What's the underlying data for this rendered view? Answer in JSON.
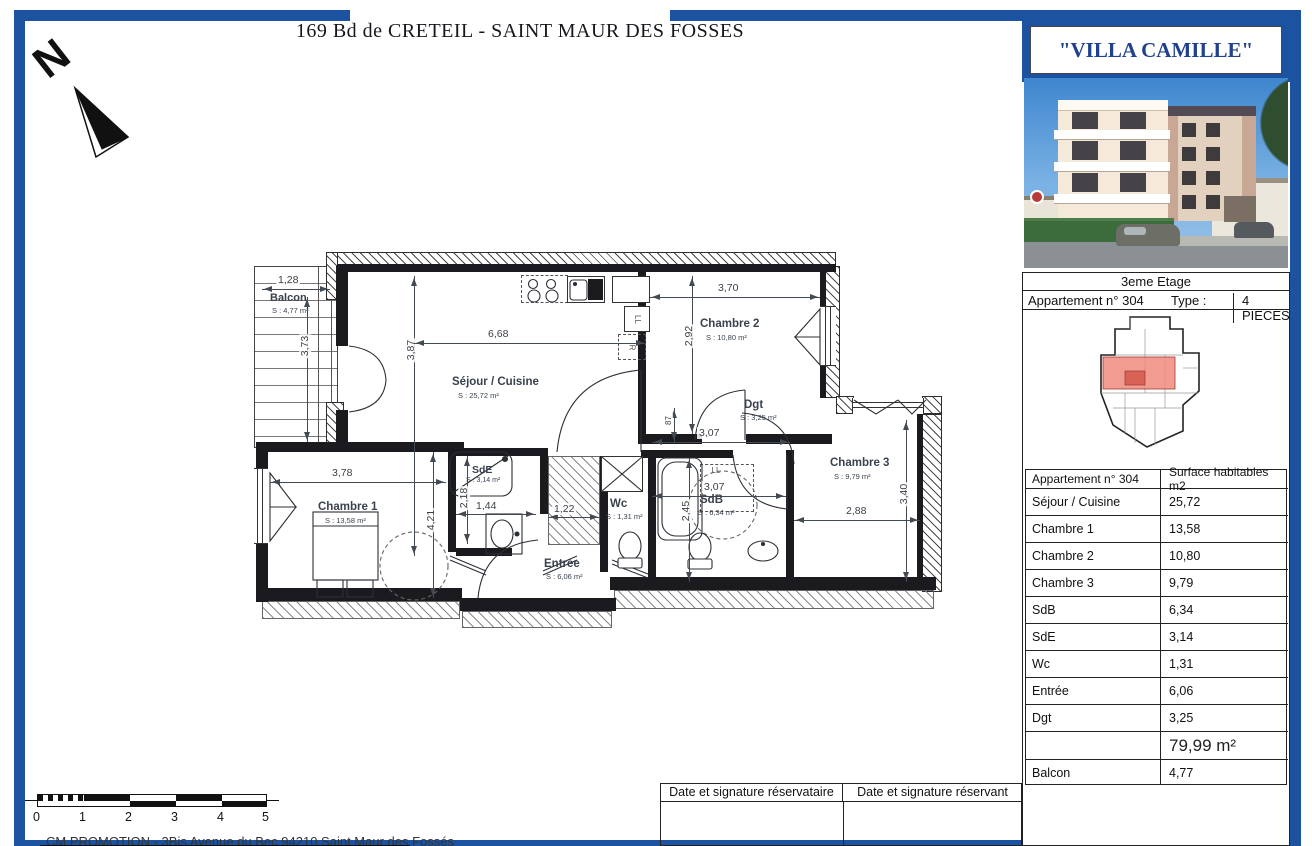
{
  "page": {
    "title": "169 Bd de CRETEIL - SAINT MAUR DES FOSSES"
  },
  "north": {
    "label": "N"
  },
  "colors": {
    "frame_blue": "#1b53a0",
    "brand_navy": "#21418c",
    "keyplan_red": "#ef8a7e"
  },
  "sidebar": {
    "residence_title": "\"VILLA CAMILLE\"",
    "building_photo": "building-photo",
    "floor": "3eme Etage",
    "apartment_label": "Appartement n° 304",
    "type_label": "Type :",
    "type_value": "4 PIECES",
    "surface_table": {
      "header": [
        "Appartement n° 304",
        "Surface habitables m2"
      ],
      "rows": [
        [
          "Séjour / Cuisine",
          "25,72"
        ],
        [
          "Chambre 1",
          "13,58"
        ],
        [
          "Chambre 2",
          "10,80"
        ],
        [
          "Chambre 3",
          "9,79"
        ],
        [
          "SdB",
          "6,34"
        ],
        [
          "SdE",
          "3,14"
        ],
        [
          "Wc",
          "1,31"
        ],
        [
          "Entrée",
          "6,06"
        ],
        [
          "Dgt",
          "3,25"
        ]
      ],
      "total": "79,99 m²",
      "balcony_row": [
        "Balcon",
        "4,77"
      ]
    }
  },
  "plan": {
    "rooms": {
      "balcon": {
        "name": "Balcon",
        "surface": "S : 4,77 m²"
      },
      "sejour": {
        "name": "Séjour / Cuisine",
        "surface": "S : 25,72 m²"
      },
      "chambre2": {
        "name": "Chambre 2",
        "surface": "S : 10,80 m²"
      },
      "dgt": {
        "name": "Dgt",
        "surface": "S : 3,25 m²"
      },
      "chambre3": {
        "name": "Chambre 3",
        "surface": "S : 9,79 m²"
      },
      "chambre1": {
        "name": "Chambre 1",
        "surface": "S : 13,58 m²"
      },
      "sde": {
        "name": "SdE",
        "surface": "S : 3,14 m²"
      },
      "sdb": {
        "name": "SdB",
        "surface": "S : 6,34 m²"
      },
      "wc": {
        "name": "Wc",
        "surface": "S : 1,31 m²"
      },
      "entree": {
        "name": "Entrée",
        "surface": "S : 6,06 m²"
      }
    },
    "dims": {
      "balcon_w": "1,28",
      "balcon_h": "3,73",
      "sejour_w": "6,68",
      "sejour_h": "3,87",
      "ch2_w": "3,70",
      "ch2_h": "2,92",
      "dgt_w": "3,07",
      "dgt_door": "87",
      "ch1_w": "3,78",
      "ch1_h": "4,21",
      "sde_h": "2,18",
      "sde_w": "1,44",
      "wc_w": "1,22",
      "sdb_h": "2,45",
      "sdb_w": "3,07",
      "ch3_w": "2,88",
      "ch3_h": "3,40"
    },
    "appliances": {
      "ll_kitchen": "LL",
      "fridge": "R",
      "ll_sdb": "LL"
    }
  },
  "scalebar": {
    "ticks": [
      "0",
      "1",
      "2",
      "3",
      "4",
      "5"
    ]
  },
  "signature": {
    "left": "Date et signature réservataire",
    "right": "Date et signature réservant"
  },
  "footer": {
    "text": "CM PROMOTION - 3Bis Avenue du Bec 94210 Saint Maur des Fossés"
  }
}
